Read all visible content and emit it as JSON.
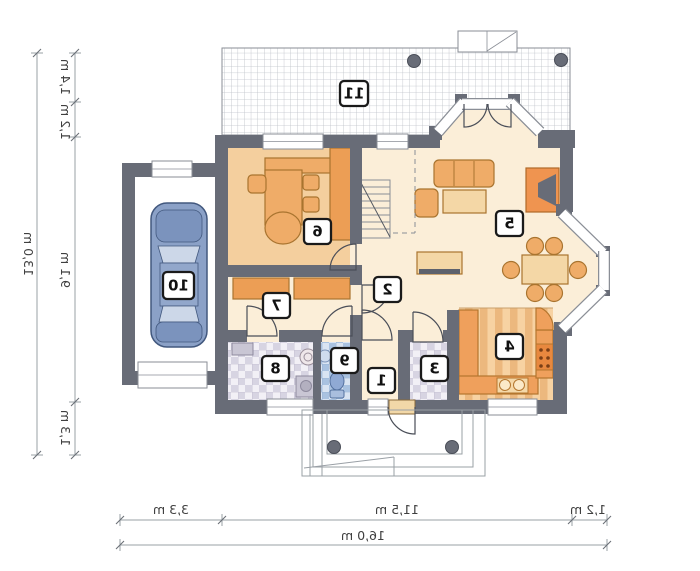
{
  "rooms": [
    {
      "number": "1"
    },
    {
      "number": "2"
    },
    {
      "number": "3"
    },
    {
      "number": "4"
    },
    {
      "number": "5"
    },
    {
      "number": "6"
    },
    {
      "number": "7"
    },
    {
      "number": "8"
    },
    {
      "number": "9"
    },
    {
      "number": "10"
    },
    {
      "number": "11"
    }
  ],
  "dimensions": {
    "left": {
      "total": "13,0 m",
      "segments": [
        "1,4 m",
        "1,2 m",
        "9,1 m",
        "1,3 m"
      ]
    },
    "bottom": {
      "total": "16,0 m",
      "segments": [
        "3,3 m",
        "11,5 m",
        "1,2 m"
      ]
    }
  },
  "colors": {
    "wall": "#686c77",
    "floor_cream": "#fbeed8",
    "floor_tan": "#f4cf9e",
    "furniture_orange": "#efac68",
    "cabinet_orange": "#ec9e55",
    "car_blue": "#8ba1c7",
    "tile_lavender": "#d7d4e2",
    "tile_blue": "#a9c2e0"
  }
}
